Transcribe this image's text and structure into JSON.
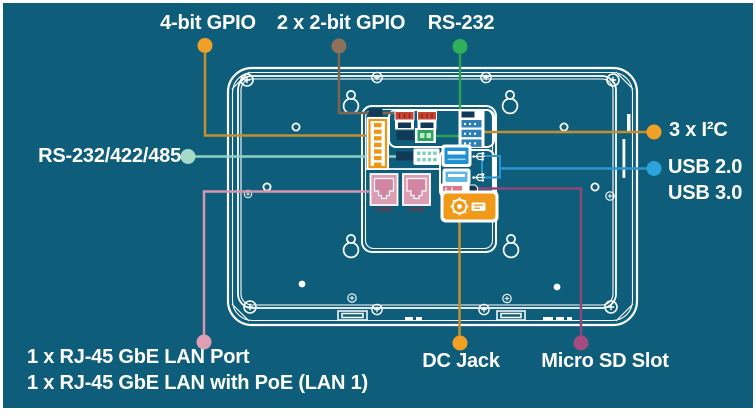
{
  "colors": {
    "background": "#0E5E7B",
    "device_line": "#FFFFFF",
    "label_text": "#FFFFFF",
    "chip_navy": "#123A57",
    "lan_text_red": "#8B2635"
  },
  "callouts": {
    "gpio4": {
      "label": "4-bit GPIO",
      "line": "#C4902E",
      "dot": "#F0A125"
    },
    "gpio2x2": {
      "label": "2 x 2-bit GPIO",
      "line": "#7E6550",
      "dot": "#8F705B"
    },
    "rs232": {
      "label": "RS-232",
      "line": "#2BA152",
      "dot": "#2FB159"
    },
    "i2c": {
      "label": "3 x I²C",
      "line": "#C4902E",
      "dot": "#F0A125"
    },
    "usb": {
      "label_usb20": "USB 2.0",
      "label_usb30": "USB 3.0",
      "line": "#2A95CF",
      "dot": "#2BA4DC"
    },
    "rs485": {
      "label": "RS-232/422/485",
      "line": "#8FD2C2",
      "dot": "#A5DAC8"
    },
    "lan": {
      "label_line1": "1 x RJ-45 GbE LAN Port",
      "label_line2": "1 x RJ-45 GbE LAN with PoE (LAN 1)",
      "line": "#D795AE",
      "dot": "#DE9FB5"
    },
    "dc": {
      "label": "DC Jack",
      "line": "#C4902E",
      "dot": "#F0A125"
    },
    "sd": {
      "label": "Micro SD Slot",
      "line": "#8F4678",
      "dot": "#A44B80"
    }
  },
  "ports": {
    "lan2_label": "LAN2",
    "lan1_label": "LAN1",
    "lan_fill": "#DC9CB2",
    "lan_jack": "#D286A2",
    "terminal_orange": "#ED9612",
    "gpio_header_red": "#C74433",
    "rs232_conn_green": "#2AA65B",
    "i2c_strip_blue": "#2E7FB5",
    "serial_pin_teal": "#7FCFC0",
    "usb3_blue": "#1F8FD2",
    "usb2_blue": "#5FB8E4",
    "sd_slot_pink": "#D8798B",
    "dc_orange": "#F09A1A"
  }
}
